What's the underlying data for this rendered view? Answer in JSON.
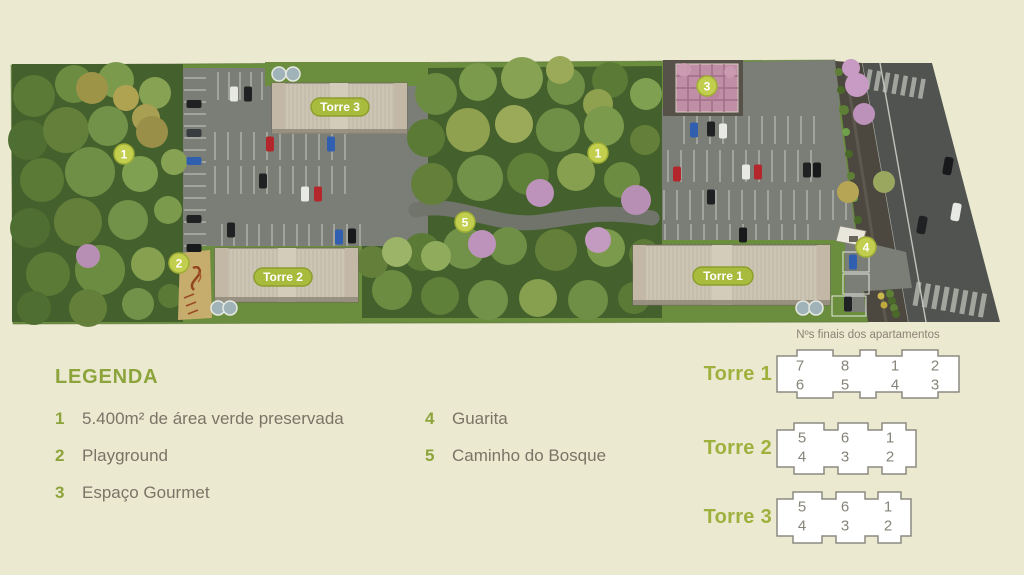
{
  "page": {
    "background": "#ECE9D1"
  },
  "site_plan": {
    "markers": [
      {
        "n": "1"
      },
      {
        "n": "2"
      },
      {
        "n": "3"
      },
      {
        "n": "4"
      },
      {
        "n": "5"
      },
      {
        "n": "1"
      }
    ],
    "tower_labels": [
      {
        "label": "Torre 3"
      },
      {
        "label": "Torre 2"
      },
      {
        "label": "Torre 1"
      }
    ],
    "colors": {
      "accent_green": "#8CA43B",
      "marker_fill": "#C2CE4D",
      "tower_pill": "#A9BB3D",
      "lawn": "#6B8E3E",
      "forest": "#44602C",
      "parking": "#7A7E76",
      "road": "#50534F",
      "building": "#CDC5B3",
      "flowering_tree": "#BD92BA"
    }
  },
  "legend": {
    "title": "LEGENDA",
    "items": [
      {
        "n": "1",
        "label": "5.400m² de área verde preservada"
      },
      {
        "n": "2",
        "label": "Playground"
      },
      {
        "n": "3",
        "label": "Espaço Gourmet"
      },
      {
        "n": "4",
        "label": "Guarita"
      },
      {
        "n": "5",
        "label": "Caminho do Bosque"
      }
    ]
  },
  "apartments": {
    "title": "Nºs finais dos apartamentos",
    "towers": [
      {
        "name": "Torre 1",
        "rows": [
          [
            "7",
            "8",
            "1",
            "2"
          ],
          [
            "6",
            "5",
            "4",
            "3"
          ]
        ]
      },
      {
        "name": "Torre 2",
        "rows": [
          [
            "5",
            "6",
            "1"
          ],
          [
            "4",
            "3",
            "2"
          ]
        ]
      },
      {
        "name": "Torre 3",
        "rows": [
          [
            "5",
            "6",
            "1"
          ],
          [
            "4",
            "3",
            "2"
          ]
        ]
      }
    ]
  }
}
